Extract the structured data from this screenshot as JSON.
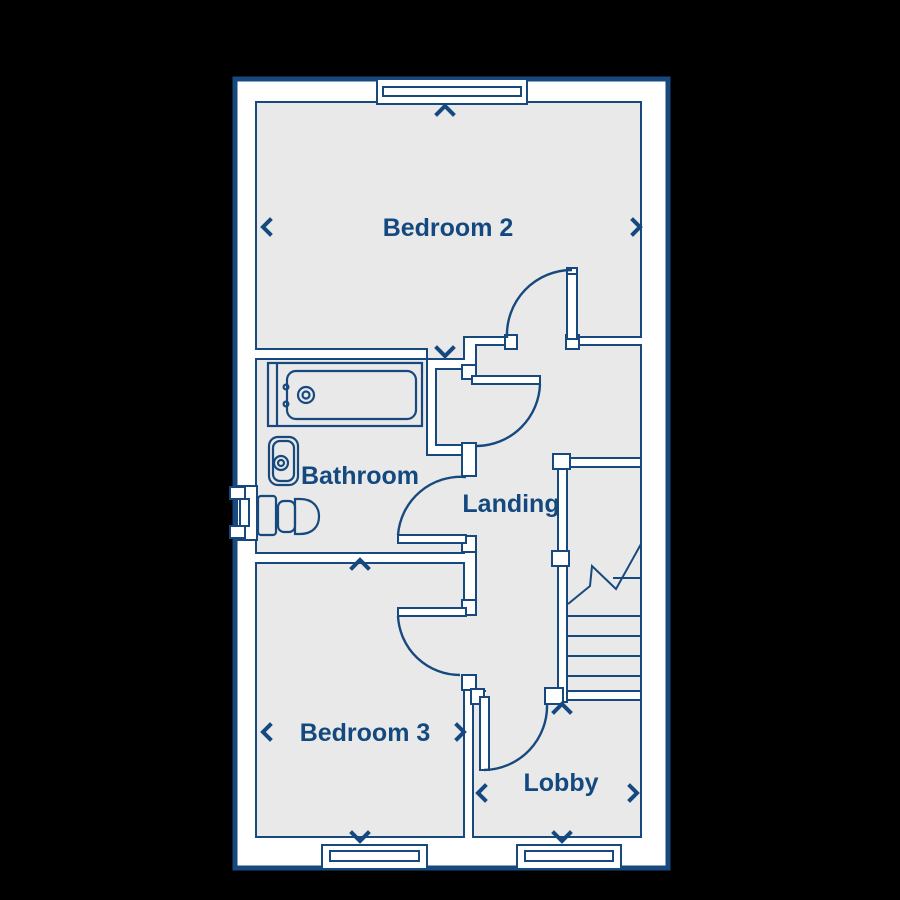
{
  "floorplan": {
    "rooms": [
      {
        "name": "Bedroom 2"
      },
      {
        "name": "Bathroom"
      },
      {
        "name": "Landing"
      },
      {
        "name": "Bedroom 3"
      },
      {
        "name": "Lobby"
      }
    ],
    "fixtures": [
      "bathtub",
      "wash-basin",
      "toilet",
      "staircase"
    ],
    "features": {
      "windows": 4,
      "doors": 5,
      "stair_break_symbol": true,
      "dimension_arrows_per_room": 4
    },
    "colors": {
      "background": "#000000",
      "wall_fill": "#ffffff",
      "floor_fill": "#e9e9e9",
      "line": "#17497E",
      "label_text": "#14497F"
    }
  }
}
